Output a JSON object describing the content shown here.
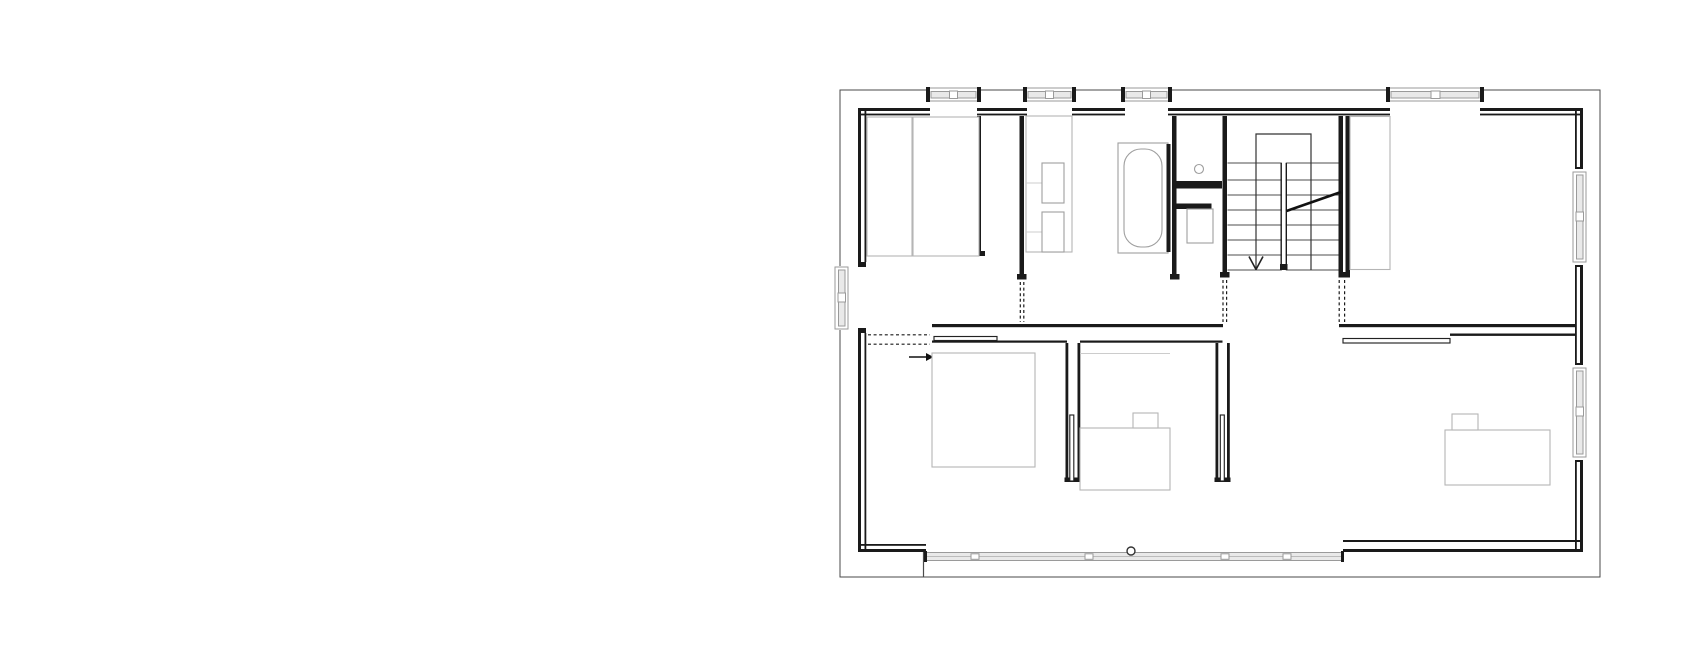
{
  "document": {
    "type": "architectural floor plan, upper storey, black line drawing on white",
    "visible_text_labels": [],
    "canvas": {
      "width": 1684,
      "height": 662
    },
    "plan_extent": {
      "left": 840,
      "top": 90,
      "right": 1600,
      "bottom": 577
    }
  },
  "colors": {
    "bg": "#ffffff",
    "wall": "#1a1a1a",
    "line2": "#4a4a4a",
    "furn": "#b5b5b5",
    "fix": "#9e9e9e",
    "winframe": "#9a9a9a",
    "winfill": "#e9e9e9",
    "tread": "#4d4d4d",
    "faint": "#cccccc"
  },
  "depicted": {
    "stair": {
      "flights": 2,
      "tread_lines": 8,
      "direction_arrow": "down",
      "section_cut_line": true
    },
    "windows": {
      "top_wall": 4,
      "left_wall": 1,
      "right_wall": 2,
      "south_glazing_band": 1
    },
    "door_openings_dashed": 3,
    "sliding_door_leaves": 4,
    "fixtures": [
      "bathtub",
      "washbasin",
      "washbasin",
      "toilet",
      "ceiling-light-circle",
      "facade-circle-marker"
    ],
    "furniture": [
      "wardrobe",
      "wardrobe",
      "wardrobe",
      "bed",
      "desk",
      "chair",
      "desk",
      "chair",
      "vanity-cabinet"
    ]
  }
}
